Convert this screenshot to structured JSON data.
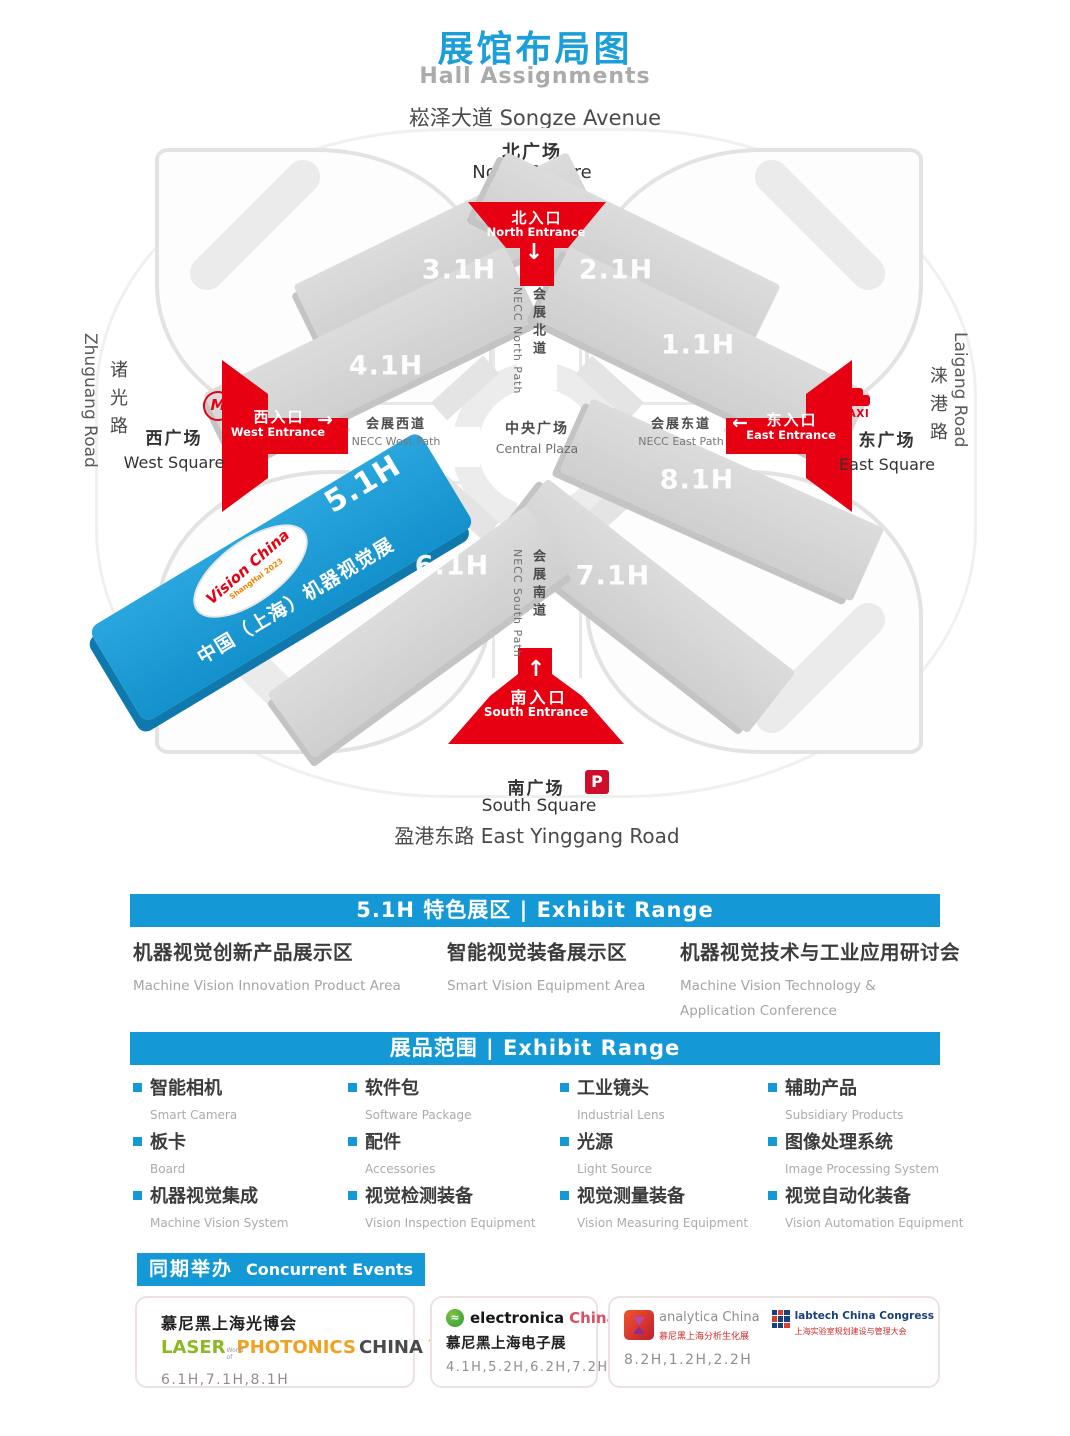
{
  "colors": {
    "accent_blue": "#1498D6",
    "title_blue": "#1C9ED9",
    "entrance_red": "#E60012",
    "hall_blue_light": "#2AA6DE",
    "hall_blue_dark": "#1391CC",
    "parking_red": "#CE0E2D"
  },
  "header": {
    "title_zh": "展馆布局图",
    "title_en": "Hall Assignments"
  },
  "map": {
    "roads": {
      "north": "崧泽大道 Songze Avenue",
      "south": "盈港东路 East Yinggang Road",
      "west_zh": "诸光路",
      "west_en": "Zhuguang Road",
      "east_zh": "涞港路",
      "east_en": "Laigang Road"
    },
    "squares": {
      "north_zh": "北广场",
      "north_en": "North Square",
      "west_zh": "西广场",
      "west_en": "West Square",
      "east_zh": "东广场",
      "east_en": "East Square",
      "south_zh": "南广场",
      "south_en": "South Square",
      "central_zh": "中央广场",
      "central_en": "Central Plaza"
    },
    "entrances": {
      "north_zh": "北入口",
      "north_en": "North Entrance",
      "west_zh": "西入口",
      "west_en": "West Entrance",
      "east_zh": "东入口",
      "east_en": "East Entrance",
      "south_zh": "南入口",
      "south_en": "South Entrance"
    },
    "paths": {
      "north_zh": "会展北道",
      "north_en": "NECC North Path",
      "west_zh": "会展西道",
      "west_en": "NECC West Path",
      "east_zh": "会展东道",
      "east_en": "NECC East Path",
      "south_zh": "会展南道",
      "south_en": "NECC South Path"
    },
    "halls": {
      "h31": "3.1H",
      "h41": "4.1H",
      "h21": "2.1H",
      "h11": "1.1H",
      "h81": "8.1H",
      "h71": "7.1H",
      "h61": "6.1H"
    },
    "feature_hall": {
      "label": "5.1H",
      "logo_line1": "Vision China",
      "logo_line2": "ShangHai 2023",
      "name": "中国（上海）机器视觉展"
    },
    "icons": {
      "metro": "M",
      "taxi": "TAXI",
      "parking": "P",
      "arrow_down": "↓",
      "arrow_up": "↑",
      "arrow_left": "←",
      "arrow_right": "→"
    }
  },
  "sections": {
    "feature": {
      "banner": "5.1H 特色展区 | Exhibit Range",
      "items": [
        {
          "zh": "机器视觉创新产品展示区",
          "en": "Machine Vision Innovation Product Area"
        },
        {
          "zh": "智能视觉装备展示区",
          "en": "Smart Vision Equipment Area"
        },
        {
          "zh": "机器视觉技术与工业应用研讨会",
          "en": "Machine Vision Technology & Application Conference"
        }
      ]
    },
    "range": {
      "banner": "展品范围 | Exhibit Range",
      "items": [
        {
          "zh": "智能相机",
          "en": "Smart Camera"
        },
        {
          "zh": "软件包",
          "en": "Software Package"
        },
        {
          "zh": "工业镜头",
          "en": "Industrial Lens"
        },
        {
          "zh": "辅助产品",
          "en": "Subsidiary Products"
        },
        {
          "zh": "板卡",
          "en": "Board"
        },
        {
          "zh": "配件",
          "en": "Accessories"
        },
        {
          "zh": "光源",
          "en": "Light Source"
        },
        {
          "zh": "图像处理系统",
          "en": "Image Processing System"
        },
        {
          "zh": "机器视觉集成",
          "en": "Machine Vision System"
        },
        {
          "zh": "视觉检测装备",
          "en": "Vision Inspection Equipment"
        },
        {
          "zh": "视觉测量装备",
          "en": "Vision Measuring Equipment"
        },
        {
          "zh": "视觉自动化装备",
          "en": "Vision Automation Equipment"
        }
      ]
    },
    "events": {
      "banner_zh": "同期举办",
      "banner_en": "Concurrent Events",
      "cards": [
        {
          "title": "慕尼黑上海光博会",
          "laser": "LASER",
          "world_of": "World of",
          "photonics": "PHOTONICS",
          "china": "CHINA",
          "halls": "6.1H,7.1H,8.1H"
        },
        {
          "brand": "electronica",
          "brand_suffix": "China",
          "title": "慕尼黑上海电子展",
          "halls": "4.1H,5.2H,6.2H,7.2H"
        },
        {
          "logo1_en": "analytica China",
          "logo1_zh": "慕尼黑上海分析生化展",
          "logo2_en": "labtech China Congress",
          "logo2_zh": "上海实验室规划建设与管理大会",
          "halls": "8.2H,1.2H,2.2H",
          "wave_icon": "≈"
        }
      ]
    }
  }
}
